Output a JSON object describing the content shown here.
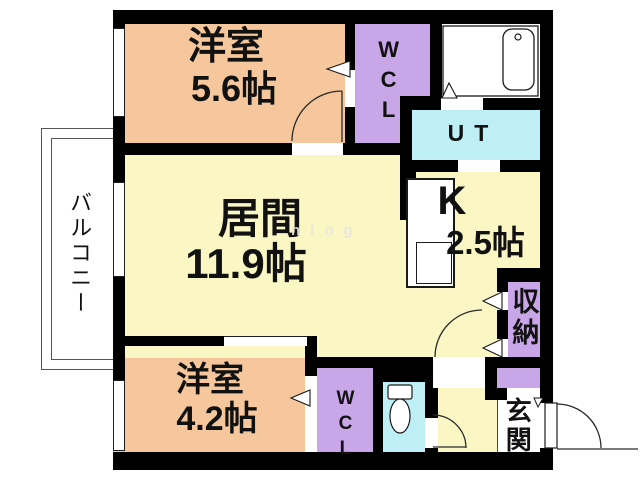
{
  "title": "1LDK+2S apartment floor plan",
  "rooms": {
    "bedroom_top": {
      "label": "洋室",
      "area": "5.6帖"
    },
    "living": {
      "label": "居間",
      "area": "11.9帖"
    },
    "bedroom_bottom": {
      "label": "洋室",
      "area": "4.2帖"
    },
    "kitchen": {
      "label": "K",
      "area": "2.5帖"
    },
    "wcl_top": {
      "label": "WCL"
    },
    "wcl_bottom": {
      "label": "WCL"
    },
    "utility": {
      "label": "UT"
    },
    "storage": {
      "label": "収納"
    },
    "entrance": {
      "label": "玄関"
    },
    "balcony": {
      "label": "バルコニー"
    }
  },
  "watermark": "niog",
  "icons": [
    "bathtub-icon",
    "toilet-icon",
    "kitchen-counter",
    "door-swing-arc",
    "door-triangle-marker"
  ],
  "colors": {
    "room_orange": "#F6C79C",
    "room_yellow": "#FBF7C5",
    "room_purple": "#C9A6E8",
    "room_cyan": "#BEEFF6",
    "wall": "#000000",
    "line": "#1f1f1f",
    "floor_white": "#FFFFFF",
    "watermark": "#E6E6DE"
  }
}
